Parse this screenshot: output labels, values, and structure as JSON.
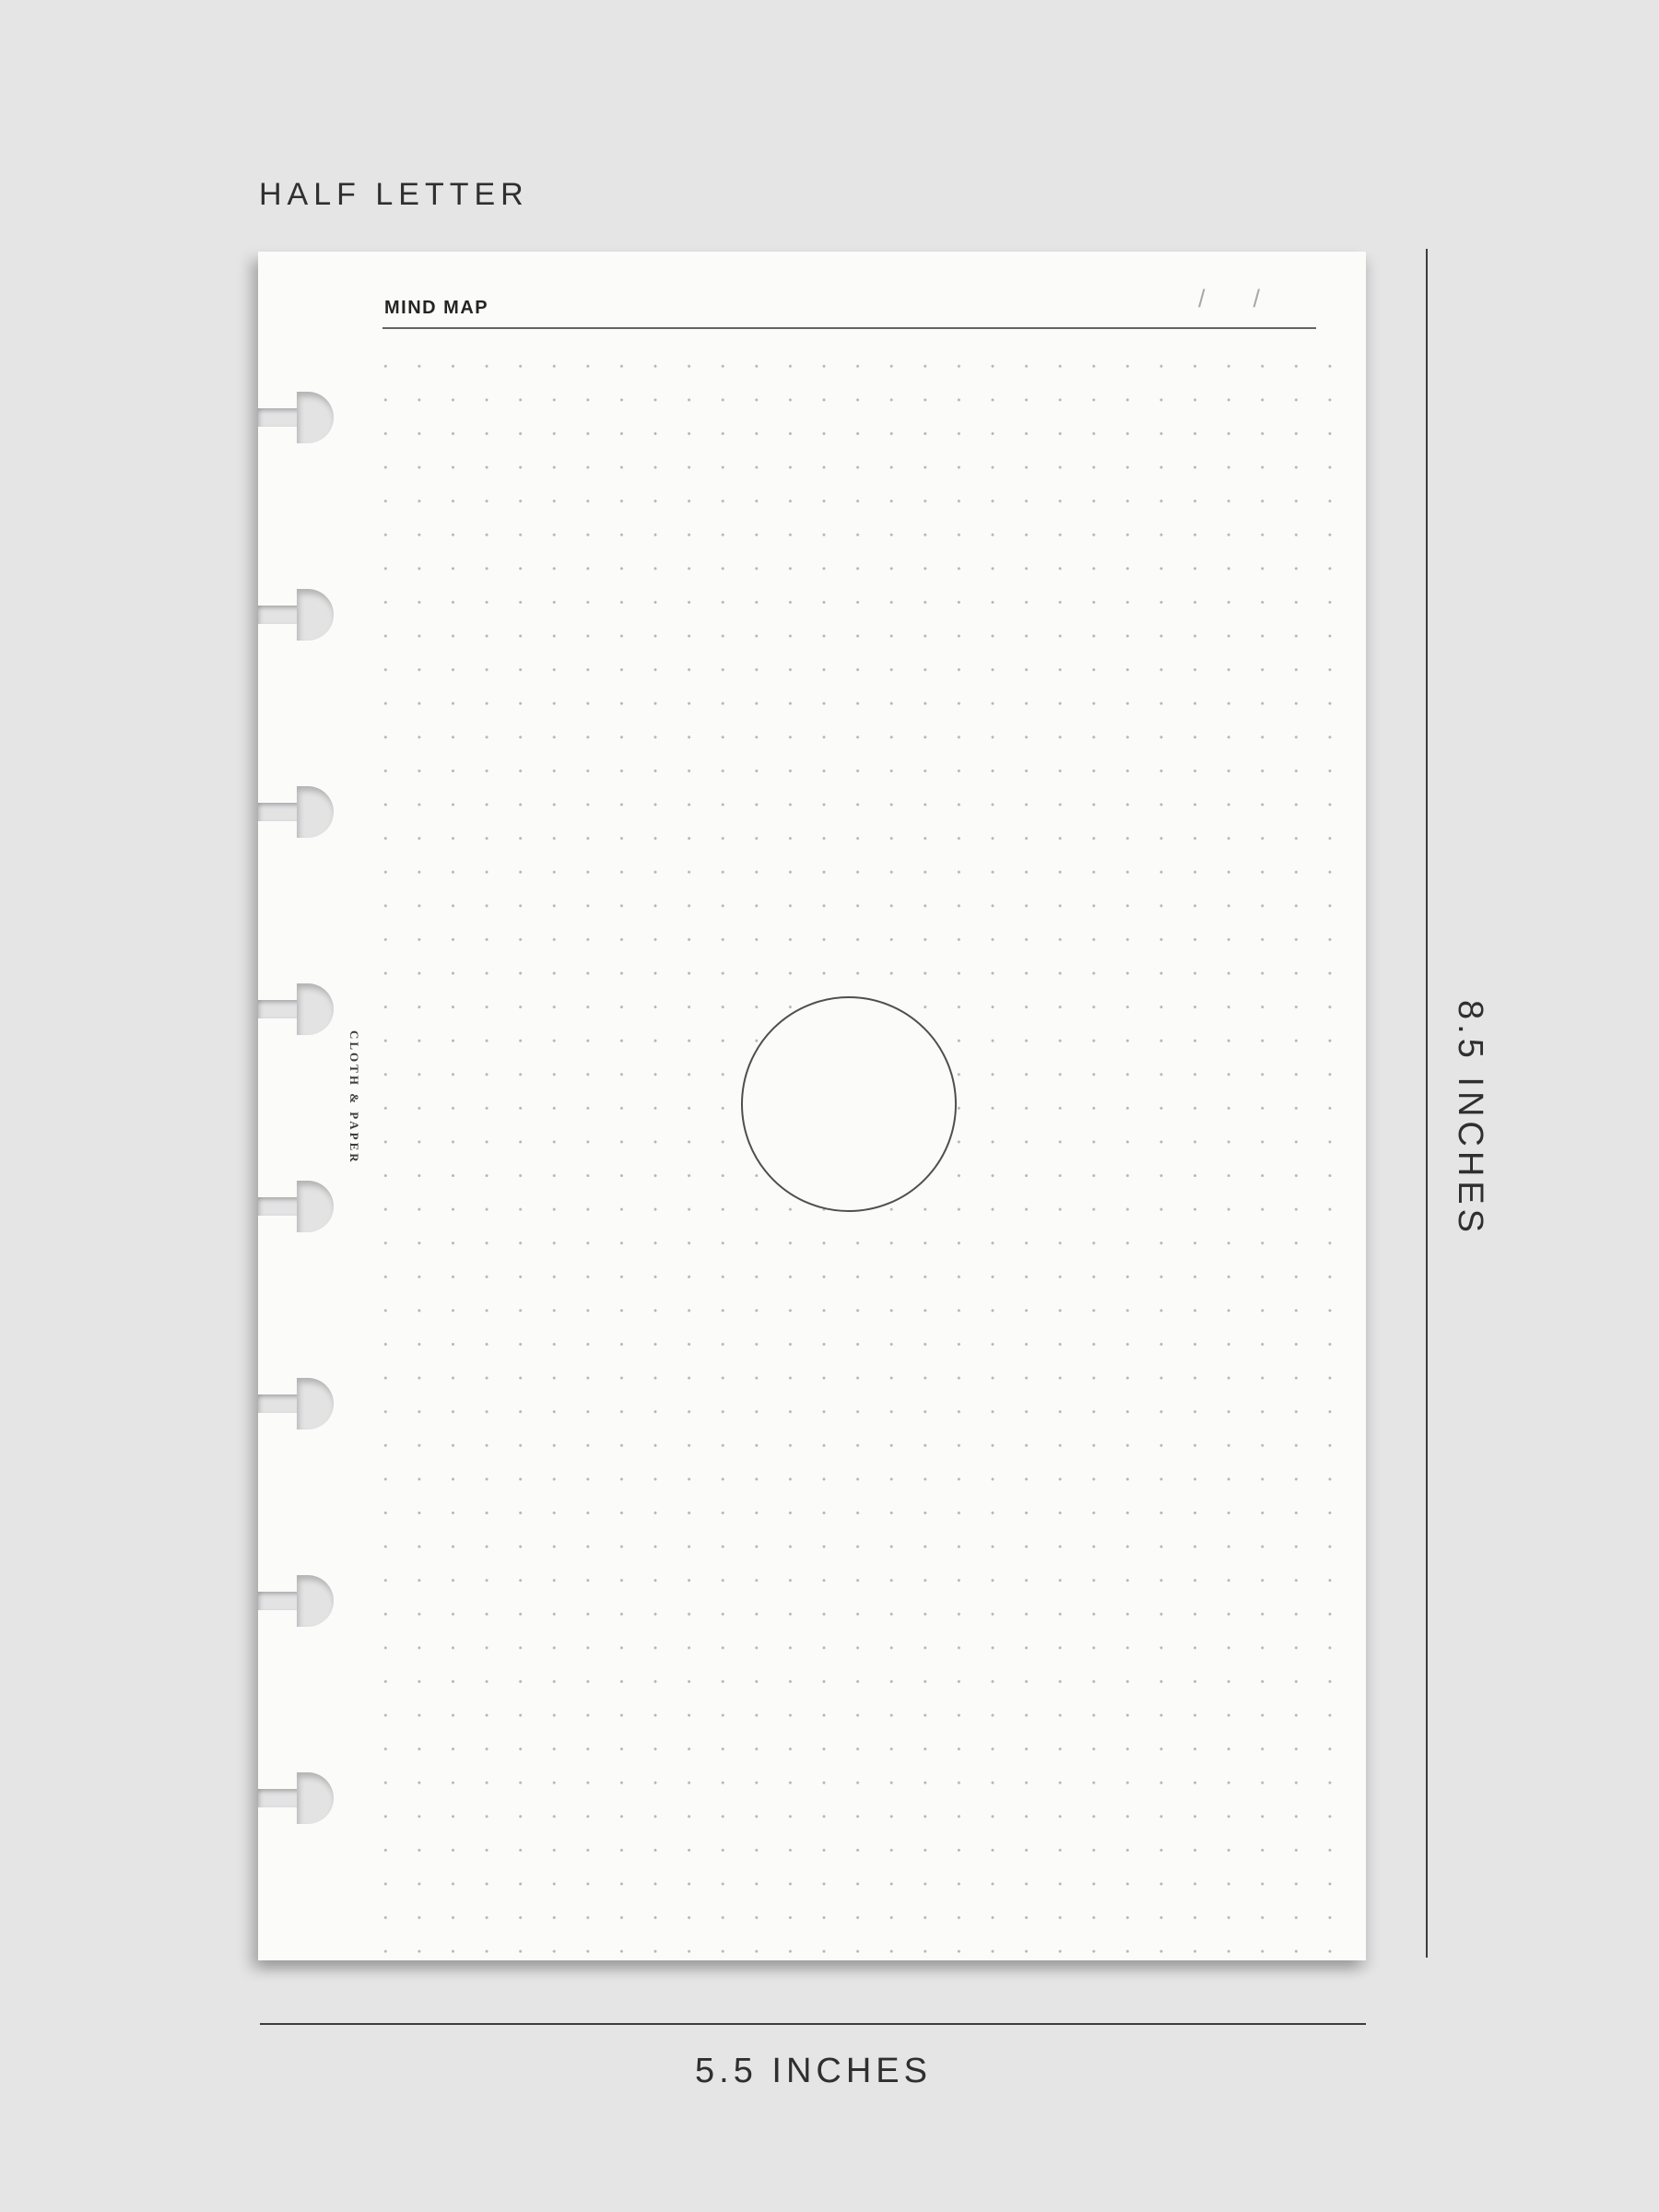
{
  "size_card": {
    "label": "HALF LETTER"
  },
  "page": {
    "header": {
      "title": "MIND MAP",
      "date_slash": "/"
    },
    "brand": "CLOTH & PAPER",
    "center_shape": "empty-circle"
  },
  "measurements": {
    "height": "8.5 INCHES",
    "width": "5.5 INCHES"
  },
  "discs": {
    "count": 8
  },
  "grid": {
    "dot_spacing_px": 36.6
  },
  "colors": {
    "background": "#e5e5e6",
    "paper": "#fbfbfa",
    "hole": "#e3e3e4",
    "text": "#2f2f2f",
    "measure_line": "#3d3d3d",
    "header_line": "#646464",
    "slash": "#a8a8a8",
    "dot": "#b5b5b5",
    "circle_stroke": "#4f4f4f",
    "brand_text": "#3b3b3b"
  }
}
